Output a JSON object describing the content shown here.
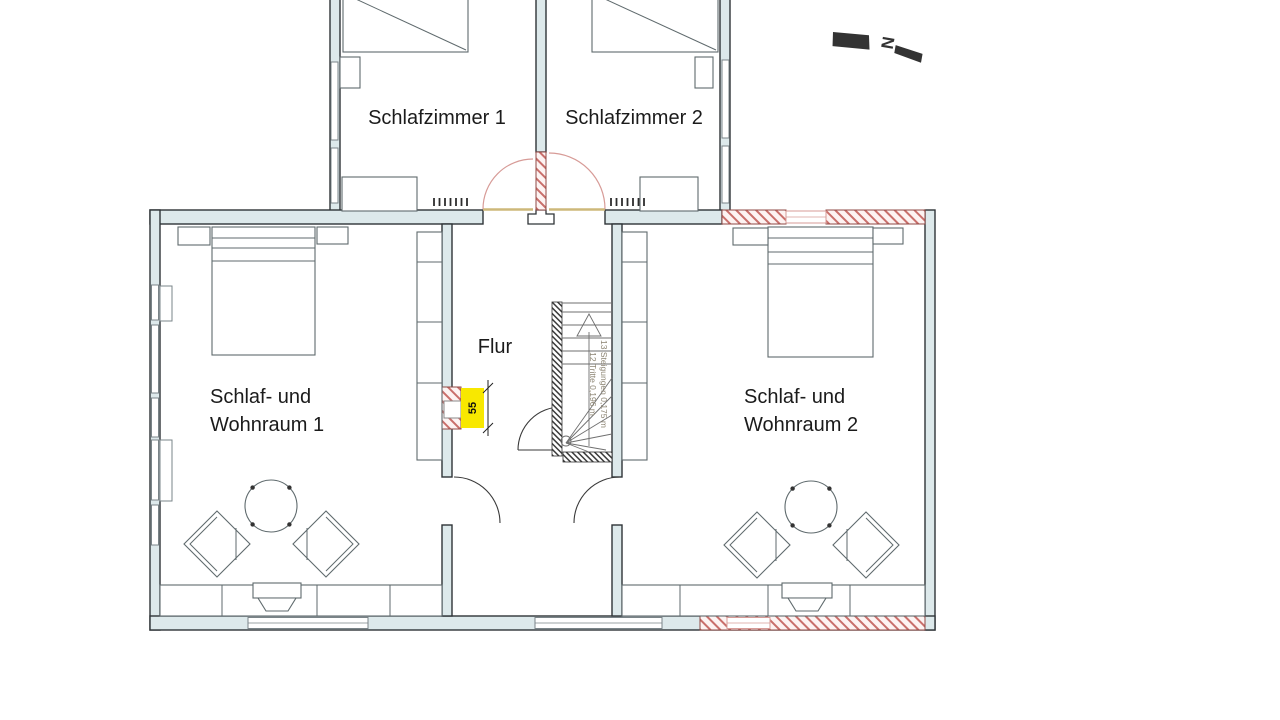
{
  "drawing": {
    "type": "floor-plan",
    "compass": {
      "label": "N"
    },
    "rooms": {
      "schlafzimmer1": {
        "label": "Schlafzimmer 1"
      },
      "schlafzimmer2": {
        "label": "Schlafzimmer 2"
      },
      "flur": {
        "label": "Flur"
      },
      "wohnraum1": {
        "line1": "Schlaf- und",
        "line2": "Wohnraum 1"
      },
      "wohnraum2": {
        "line1": "Schlaf- und",
        "line2": "Wohnraum 2"
      }
    },
    "stairs": {
      "note_line1": "13 Steigungen 0,175 m",
      "note_line2": "12 Tritte 0,196 m"
    },
    "dimension": {
      "value": "55"
    },
    "colors": {
      "wall_fill": "#dde9eb",
      "wall_stroke": "#2f3437",
      "furniture_stroke": "#5f6a6d",
      "door_arc": "#d79b97",
      "hatch_red": "#c96f6b",
      "hatch_bg": "#fdf3f2",
      "highlight_yellow": "#f8e800",
      "threshold_tan": "#cdb87a",
      "stair_note": "#8c8472",
      "label_color": "#1b1b1b"
    }
  }
}
